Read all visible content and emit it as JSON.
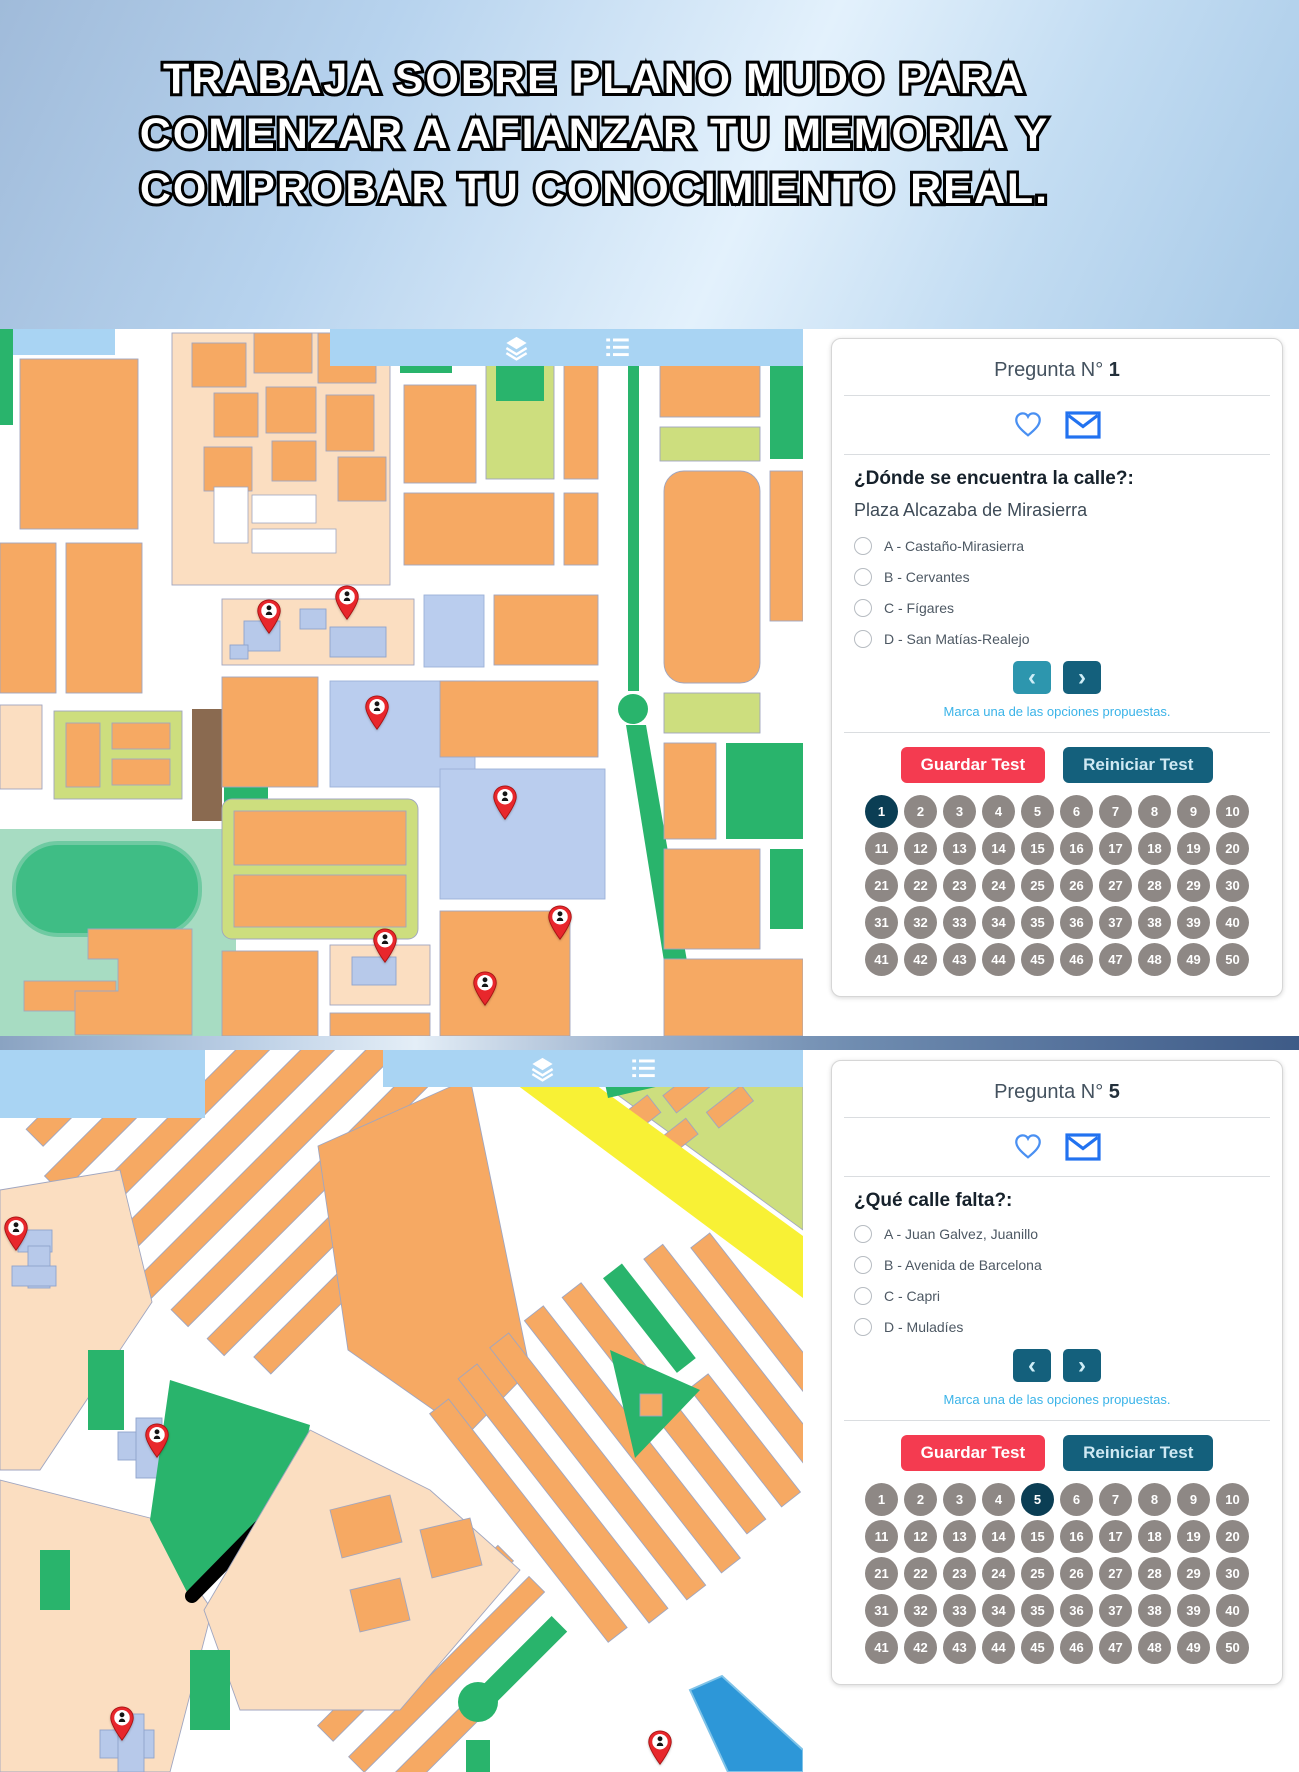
{
  "banner": {
    "lines": [
      "TRABAJA SOBRE PLANO MUDO PARA",
      "COMENZAR A AFIANZAR TU MEMORIA Y",
      "COMPROBAR TU CONOCIMIENTO REAL."
    ]
  },
  "palette": {
    "block_orange": "#f6a963",
    "block_peach": "#fbdec1",
    "park_green": "#29b46c",
    "strip_green": "#cdde7e",
    "mint_green": "#a7dcc2",
    "building_blue": "#b7c9ea",
    "plaza_blue": "#bacdee",
    "toolbar_blue": "#a9d4f3",
    "road_yellow": "#f8f135",
    "water_blue": "#2d97d8",
    "soil_brown": "#8a6a50",
    "outline": "#a0a6c0",
    "marker_red": "#e8272c",
    "accent_blue": "#3f8ef2",
    "hint_blue": "#3ab3e8",
    "btn_red": "#f43b50",
    "btn_teal": "#14607c",
    "btn_teal_muted": "#2d96ae",
    "grid_active": "#0b3e54",
    "grid_inactive": "#8e8885"
  },
  "map_top": {
    "toolbar_icons": [
      "layers-icon",
      "list-icon"
    ],
    "markers": [
      {
        "x": 33.5,
        "y": 43.3
      },
      {
        "x": 43.2,
        "y": 41.3
      },
      {
        "x": 46.9,
        "y": 56.9
      },
      {
        "x": 62.9,
        "y": 69.6
      },
      {
        "x": 47.9,
        "y": 89.8
      },
      {
        "x": 69.7,
        "y": 86.6
      },
      {
        "x": 60.4,
        "y": 95.9
      }
    ]
  },
  "map_bottom": {
    "toolbar_icons": [
      "layers-icon",
      "list-icon"
    ],
    "markers": [
      {
        "x": 2.0,
        "y": 28.0
      },
      {
        "x": 19.6,
        "y": 56.6
      },
      {
        "x": 15.2,
        "y": 95.8
      },
      {
        "x": 82.2,
        "y": 99.2
      }
    ]
  },
  "question_card_1": {
    "title_prefix": "Pregunta N°",
    "title_number": "1",
    "icon_names": [
      "heart-icon",
      "envelope-icon"
    ],
    "question": "¿Dónde se encuentra la calle?:",
    "street": "Plaza Alcazaba de Mirasierra",
    "options": [
      "A - Castaño-Mirasierra",
      "B - Cervantes",
      "C - Fígares",
      "D - San Matías-Realejo"
    ],
    "nav": {
      "prev_glyph": "‹",
      "next_glyph": "›",
      "prev_class": "navbtn muted",
      "next_class": "navbtn"
    },
    "hint": "Marca una de las opciones propuestas.",
    "save_label": "Guardar Test",
    "reset_label": "Reiniciar Test",
    "grid": {
      "total": 50,
      "active": 1
    }
  },
  "question_card_2": {
    "title_prefix": "Pregunta N°",
    "title_number": "5",
    "icon_names": [
      "heart-icon",
      "envelope-icon"
    ],
    "question": "¿Qué calle falta?:",
    "options": [
      "A - Juan Galvez, Juanillo",
      "B - Avenida de Barcelona",
      "C - Capri",
      "D - Muladíes"
    ],
    "nav": {
      "prev_glyph": "‹",
      "next_glyph": "›",
      "prev_class": "navbtn",
      "next_class": "navbtn"
    },
    "hint": "Marca una de las opciones propuestas.",
    "save_label": "Guardar Test",
    "reset_label": "Reiniciar Test",
    "grid": {
      "total": 50,
      "active": 5
    }
  }
}
